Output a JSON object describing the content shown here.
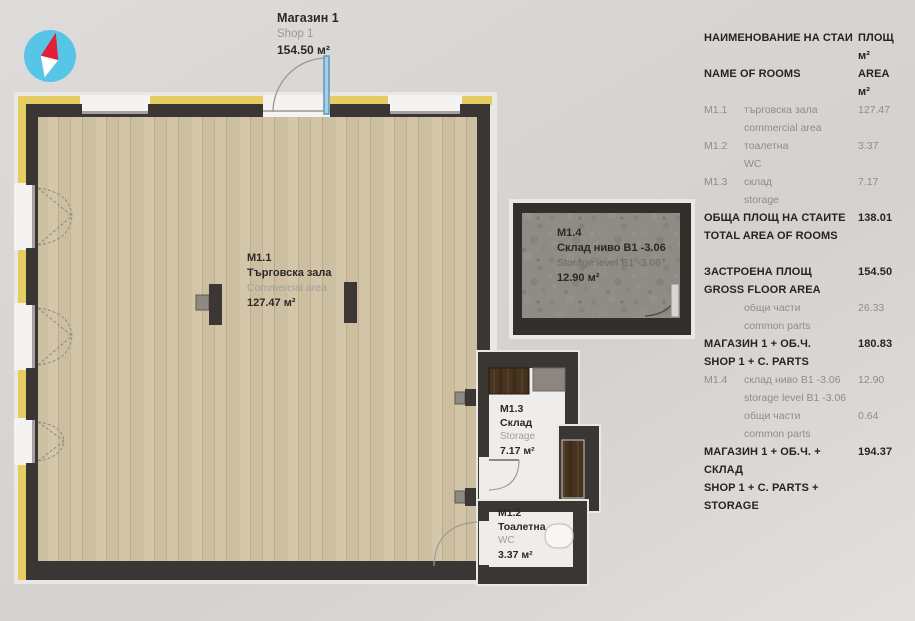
{
  "shop_label": {
    "id": "Магазин 1",
    "name_en": "Shop 1",
    "area": "154.50 м²"
  },
  "rooms": [
    {
      "id": "M1.1",
      "name_bg": "Търговска зала",
      "name_en": "Commercial area",
      "area": "127.47 м²"
    },
    {
      "id": "M1.2",
      "name_bg": "Тоалетна",
      "name_en": "WC",
      "area": "3.37 м²"
    },
    {
      "id": "M1.3",
      "name_bg": "Склад",
      "name_en": "Storage",
      "area": "7.17 м²"
    },
    {
      "id": "M1.4",
      "name_bg": "Склад ниво B1 -3.06",
      "name_en": "Storage level B1 -3.06",
      "area": "12.90 м²"
    }
  ],
  "legend": {
    "header": {
      "col1_bg": "НАИМЕНОВАНИЕ НА СТАИ",
      "col1_en": "NAME OF ROOMS",
      "col2_bg": "ПЛОЩ м²",
      "col2_en": "AREA м²"
    },
    "rows": [
      {
        "code": "M1.1",
        "bg": "търговска зала",
        "en": "commercial area",
        "value": "127.47"
      },
      {
        "code": "M1.2",
        "bg": "тоалетна",
        "en": "WC",
        "value": "3.37"
      },
      {
        "code": "M1.3",
        "bg": "склад",
        "en": "storage",
        "value": "7.17"
      },
      {
        "bg": "ОБЩА ПЛОЩ НА СТАИТЕ",
        "en": "TOTAL AREA OF ROOMS",
        "value": "138.01"
      },
      {
        "bg": "ЗАСТРОЕНА ПЛОЩ",
        "en": "GROSS FLOOR AREA",
        "value": "154.50"
      },
      {
        "code": "",
        "bg": "общи части",
        "en": "common parts",
        "value": "26.33"
      },
      {
        "bg": "МАГАЗИН 1 + ОБ.Ч.",
        "en": "SHOP 1 + C. PARTS",
        "value": "180.83"
      },
      {
        "code": "M1.4",
        "bg": "склад ниво B1 -3.06",
        "en": "storage level B1 -3.06",
        "value": "12.90"
      },
      {
        "code": "",
        "bg": "общи части",
        "en": "common parts",
        "value": "0.64"
      },
      {
        "bg": "МАГАЗИН 1 + ОБ.Ч. + СКЛАД",
        "en": "SHOP 1 + C. PARTS + STORAGE",
        "value": "194.37"
      }
    ]
  },
  "icons": {
    "compass": "north-arrow"
  },
  "colors": {
    "wall_dark": "#3a3633",
    "insulation_yellow": "#e6cd62",
    "wood_floor": "#cfc1a3",
    "concrete_floor": "#8f8b85",
    "door_blue": "#8fbedd",
    "compass_blue": "#57c5e6",
    "compass_red": "#e41f38"
  }
}
